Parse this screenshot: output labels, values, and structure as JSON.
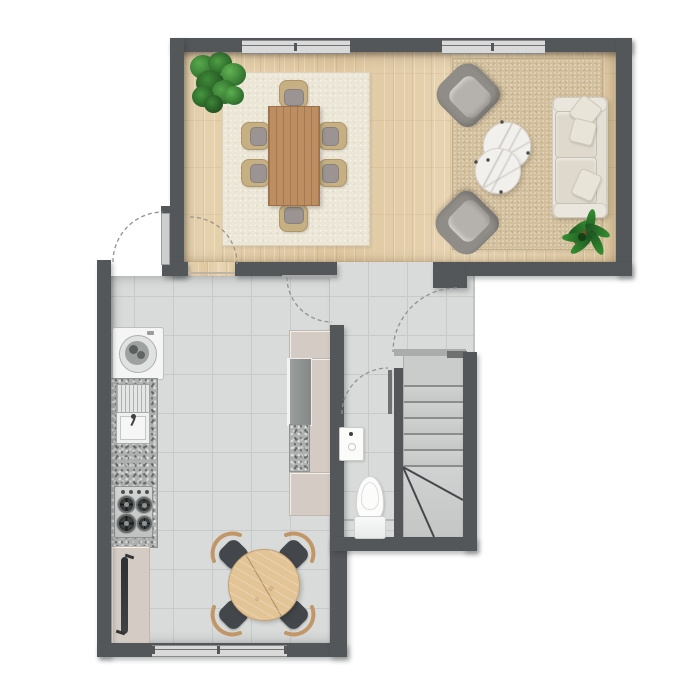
{
  "meta": {
    "type": "floor-plan",
    "view": "top-down",
    "text_labels": []
  },
  "palette": {
    "wall": "#54575a",
    "outside": "#ffffff",
    "tile_floor": "#d9dbda",
    "tile_grout": "#c7cac9",
    "wood_floor": "#e3cda9",
    "dining_rug": "#ece6d7",
    "living_rug": "#d2bf9c",
    "sofa": "#eae6dd",
    "armchair": "#908c88",
    "marble_table": "#f2f0ed",
    "dining_table_wood": "#bd8e62",
    "kitchen_table_wood": "#e2c497",
    "kitchen_chair": "#43474b",
    "chair_arm_wood": "#c29768",
    "cabinet_beige": "#d4cbc4",
    "granite": "#adb0ae",
    "appliance_white": "#f4f5f4",
    "stair_tread": "#c9ccca",
    "plant_green": "#3e8a37",
    "door_arc": "#8f9193",
    "window_glass": "#d8d9d8"
  },
  "rooms": {
    "living_dining": {
      "label": "living / dining room",
      "floor": "wood planks",
      "window_count": 2,
      "furniture": {
        "dining_rug": "dining area rug",
        "dining_table": "rectangular dining table",
        "dining_chairs": "6 dining chairs",
        "plant_corner": "potted plant",
        "living_rug": "woven area rug",
        "sofa": "three-seat sofa",
        "pillows": "3 throw pillows",
        "armchair_top": "swivel armchair",
        "armchair_bottom": "swivel armchair",
        "coffee_table_large": "round marble coffee table",
        "coffee_table_small": "round marble coffee table",
        "plant_sofa": "potted plant"
      }
    },
    "kitchen": {
      "label": "kitchen",
      "floor": "tile",
      "window_count": 1,
      "furniture": {
        "washing_machine": "washing machine",
        "sink": "kitchen sink with drainboard",
        "counter": "granite counter",
        "hob": "gas hob 4 burners",
        "radiator": "radiator cabinet",
        "tall_unit": "tall cabinet with fridge",
        "round_table": "round wooden table",
        "chairs": "4 chairs"
      }
    },
    "bathroom": {
      "label": "toilet room",
      "floor": "tile",
      "fixtures": {
        "basin": "wash basin",
        "toilet": "toilet"
      }
    },
    "stairs": {
      "label": "staircase",
      "straight_treads": 6,
      "winders": 3
    },
    "doors": {
      "entrance": "entrance door (swings out)",
      "dining": "dining room door",
      "kitchen": "kitchen door",
      "hall": "hall door",
      "bathroom": "toilet door"
    }
  }
}
